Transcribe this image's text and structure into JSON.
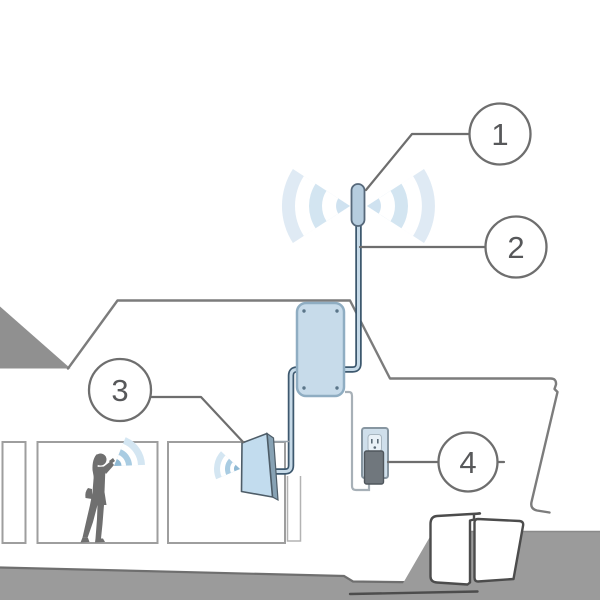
{
  "diagram": {
    "type": "installation-illustration",
    "scene": "house-cross-section-with-signal-booster"
  },
  "callouts": [
    {
      "label": "1",
      "component": "outdoor-antenna"
    },
    {
      "label": "2",
      "component": "antenna-cable"
    },
    {
      "label": "3",
      "component": "indoor-panel-antenna"
    },
    {
      "label": "4",
      "component": "power-outlet-plug"
    }
  ],
  "colors": {
    "background": "#ffffff",
    "device_fill": "#c7dbea",
    "device_stroke": "#56687a",
    "booster_stroke": "#8fadc2",
    "cable_dark": "#3d586e",
    "cable_light": "#c6dae8",
    "leader_line": "#6e6e6e",
    "roof_outline": "#7c7c7c",
    "room_outline": "#9e9e9e",
    "ground": "#9b9b9b",
    "dark_roof_triangle": "#909090",
    "silhouette": "#6f6f6f",
    "wave_pale": "#dfeaf4",
    "wave_mid": "#a9cce2",
    "wave_dark": "#8fb9d4",
    "number_text": "#57585a",
    "outlet_plate": "#cfdfeb",
    "plug_body": "#70777d"
  }
}
